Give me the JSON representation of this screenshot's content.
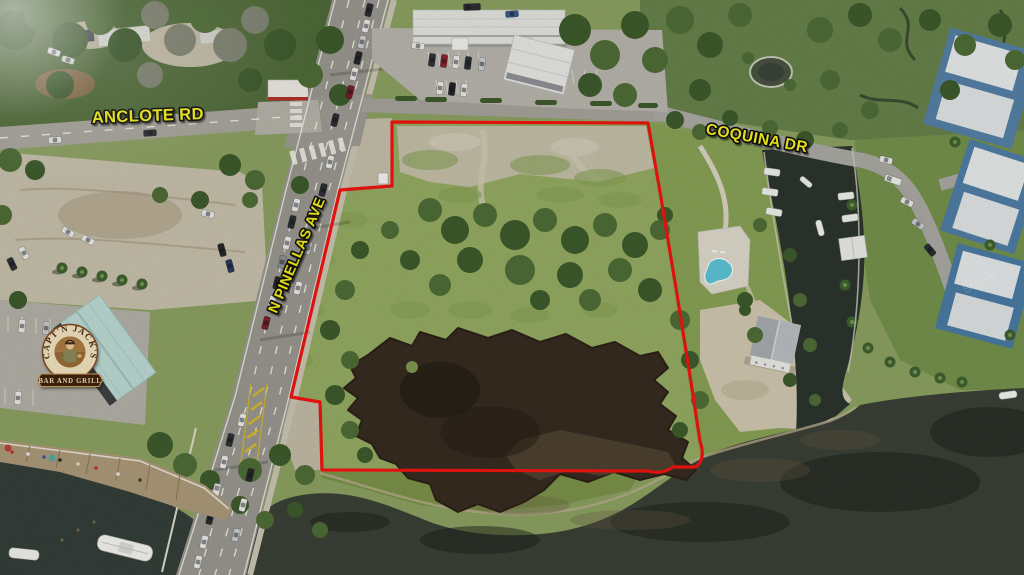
{
  "overlays": {
    "road_labels": [
      {
        "id": "anclote",
        "text": "ANCLOTE RD"
      },
      {
        "id": "pinellas",
        "text": "N PINELLAS AVE"
      },
      {
        "id": "coquina",
        "text": "COQUINA DR"
      }
    ],
    "logo": {
      "arc_text": "CAPT'N JACK'S",
      "banner_text": "BAR AND GRILL"
    },
    "watermark": "Stellar"
  },
  "colors": {
    "boundary": "#ee1410",
    "label": "#f2ee1b",
    "pool": "#5cc2d4",
    "logo_ring": "#efe1bd",
    "logo_text": "#4a2810",
    "banner": "#3f2410",
    "banner_text": "#eedcb2"
  }
}
